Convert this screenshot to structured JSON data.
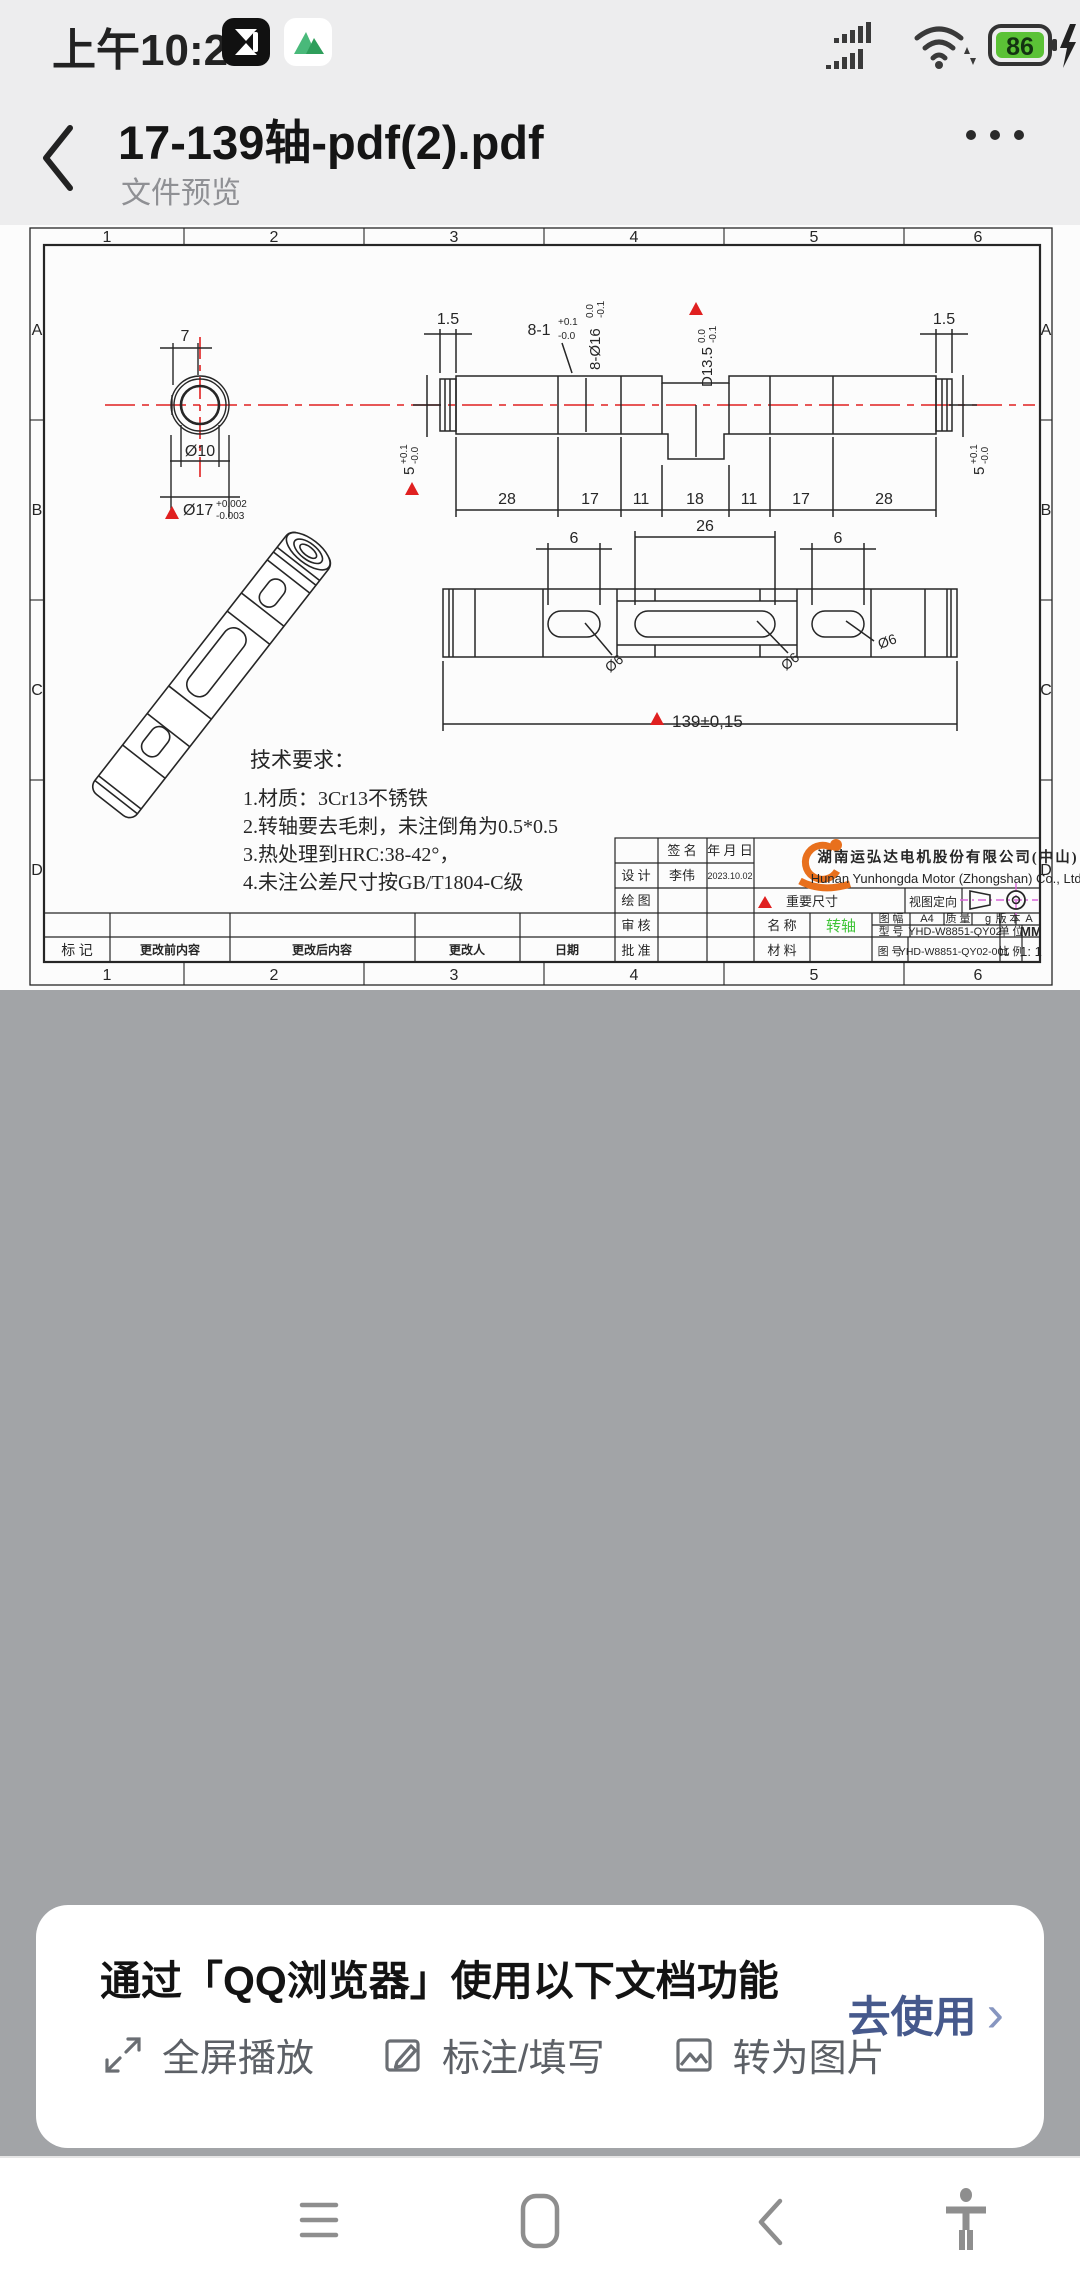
{
  "status_bar": {
    "time": "上午10:26",
    "battery": "86"
  },
  "header": {
    "title": "17-139轴-pdf(2).pdf",
    "subtitle": "文件预览"
  },
  "drawing": {
    "cols": [
      "1",
      "2",
      "3",
      "4",
      "5",
      "6"
    ],
    "rows": [
      "A",
      "B",
      "C",
      "D"
    ],
    "end_view": {
      "w": "7",
      "inner": "Ø10",
      "outer": "Ø17",
      "tu": "+0.002",
      "td": "-0.003"
    },
    "side": {
      "e_l": "1.5",
      "e_r": "1.5",
      "slot": "8-1",
      "slot_tu": "+0.1",
      "slot_td": "-0.0",
      "dia": "8-Ø16",
      "dia_tu": "0.0",
      "dia_td": "-0.1",
      "dd": "D13.5",
      "dd_tu": "0.0",
      "dd_td": "-0.1",
      "five_l": "5",
      "five_l_tu": "+0.1",
      "five_l_td": "-0.0",
      "five_r": "5",
      "five_r_tu": "+0.1",
      "five_r_td": "-0.0",
      "seg": [
        "28",
        "17",
        "11",
        "18",
        "11",
        "17",
        "28"
      ]
    },
    "top": {
      "s1": "6",
      "s2": "26",
      "s3": "6",
      "d1": "Ø6",
      "d2": "Ø6",
      "d3": "Ø6",
      "overall": "139±0,15"
    },
    "tech": {
      "t": "技术要求：",
      "l1": "1.材质：3Cr13不锈铁",
      "l2": "2.转轴要去毛刺，未注倒角为0.5*0.5",
      "l3": "3.热处理到HRC:38-42°，",
      "l4": "4.未注公差尺寸按GB/T1804-C级"
    },
    "tb": {
      "sign": "签 名",
      "ymd": "年 月 日",
      "design": "设 计",
      "designer": "李伟",
      "date": "2023.10.02",
      "draw": "绘 图",
      "review": "审 核",
      "approve": "批 准",
      "important": "重要尺寸",
      "orient": "视图定向",
      "name": "名 称",
      "name_v": "转轴",
      "material": "材 料",
      "fmt": "图 幅",
      "fmt_v": "A4",
      "mass": "质 量",
      "mass_v": "g",
      "ver": "版 本",
      "ver_v": "A",
      "model": "型 号",
      "model_v": "YHD-W8851-QY02",
      "unit": "单 位",
      "unit_v": "MM",
      "dno": "图 号",
      "dno_v": "YHD-W8851-QY02-001",
      "scale": "比 例",
      "scale_v": "1: 1",
      "cn": "湖南运弘达电机股份有限公司(中山)",
      "en": "Hunan Yunhongda Motor (Zhongshan) Co., Ltd."
    },
    "rev": {
      "mark": "标 记",
      "before": "更改前内容",
      "after": "更改后内容",
      "who": "更改人",
      "date": "日期"
    },
    "colors": {
      "line": "#262626",
      "red": "#e02020",
      "green": "#3ec437",
      "orange": "#e8701d",
      "magenta": "#d964d9"
    }
  },
  "sheet": {
    "title": "通过「QQ浏览器」使用以下文档功能",
    "actions": [
      "全屏播放",
      "标注/填写",
      "转为图片"
    ],
    "cta": "去使用",
    "chev": "›"
  }
}
